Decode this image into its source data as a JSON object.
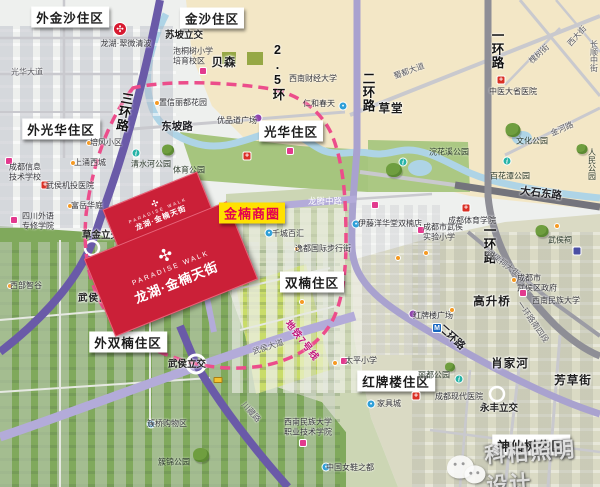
{
  "watermark": {
    "brand": "科柏照明设计",
    "icon": "wechat-icon"
  },
  "badge": {
    "text": "金楠商圈"
  },
  "paradise_walk": {
    "en": "PARADISE WALK",
    "zh": "龙湖·金楠天街"
  },
  "colors": {
    "accent_red": "#cb2038",
    "badge_yellow": "#ffe100",
    "badge_text": "#e5004f",
    "metro_pink": "#ec4d8b",
    "ring_purple": "#6a5aa8",
    "minor_purple": "#b3abd9"
  },
  "districts": [
    {
      "t": "外金沙住区",
      "x": 70,
      "y": 17
    },
    {
      "t": "金沙住区",
      "x": 212,
      "y": 18
    },
    {
      "t": "外光华住区",
      "x": 61,
      "y": 129
    },
    {
      "t": "光华住区",
      "x": 291,
      "y": 131
    },
    {
      "t": "双楠住区",
      "x": 312,
      "y": 282
    },
    {
      "t": "外双楠住区",
      "x": 128,
      "y": 342
    },
    {
      "t": "红牌楼住区",
      "x": 396,
      "y": 381
    },
    {
      "t": "神仙树住区",
      "x": 531,
      "y": 445
    }
  ],
  "zones": [
    {
      "t": "草堂",
      "x": 391,
      "y": 108
    },
    {
      "t": "贝森",
      "x": 224,
      "y": 62
    },
    {
      "t": "高升桥",
      "x": 492,
      "y": 301
    },
    {
      "t": "肖家河",
      "x": 510,
      "y": 363
    },
    {
      "t": "芳草街",
      "x": 573,
      "y": 380
    },
    {
      "t": "武侯区青年创业园",
      "x": 120,
      "y": 297,
      "sm": true
    }
  ],
  "junctions": [
    {
      "t": "苏坡立交",
      "x": 184,
      "y": 34
    },
    {
      "t": "草金立交",
      "x": 101,
      "y": 234
    },
    {
      "t": "武侯立交",
      "x": 187,
      "y": 363
    },
    {
      "t": "永丰立交",
      "x": 499,
      "y": 407
    }
  ],
  "roads": [
    {
      "t": "三环路",
      "x": 124,
      "y": 112,
      "v": true,
      "ring": true,
      "rot": 10
    },
    {
      "t": "二环路",
      "x": 368,
      "y": 92,
      "v": true,
      "ring": true
    },
    {
      "t": "一环路",
      "x": 497,
      "y": 49,
      "v": true,
      "ring": true
    },
    {
      "t": "一环路",
      "x": 489,
      "y": 244,
      "v": true,
      "ring": true
    },
    {
      "t": "2.5环",
      "x": 278,
      "y": 72,
      "v": true,
      "ring": true
    },
    {
      "t": "二环路",
      "x": 452,
      "y": 337,
      "rot": 42,
      "b": true
    },
    {
      "t": "一环路南四段",
      "x": 533,
      "y": 322,
      "rot": 55
    },
    {
      "t": "大石东路",
      "x": 541,
      "y": 193,
      "rot": 7,
      "b": true
    },
    {
      "t": "东坡路",
      "x": 177,
      "y": 126,
      "b": true
    },
    {
      "t": "光华大道",
      "x": 27,
      "y": 72
    },
    {
      "t": "蜀都大道",
      "x": 409,
      "y": 71,
      "rot": -20
    },
    {
      "t": "西大街",
      "x": 577,
      "y": 36,
      "rot": -48
    },
    {
      "t": "长顺中街",
      "x": 594,
      "y": 56,
      "v": true
    },
    {
      "t": "槐树街",
      "x": 539,
      "y": 54,
      "rot": -42
    },
    {
      "t": "金河路",
      "x": 562,
      "y": 129,
      "rot": -24
    },
    {
      "t": "武侯祠大街",
      "x": 503,
      "y": 263,
      "rot": 37
    },
    {
      "t": "武侯大道",
      "x": 268,
      "y": 347,
      "rot": -18
    },
    {
      "t": "川藏路",
      "x": 251,
      "y": 412,
      "rot": 48
    },
    {
      "t": "龙腾中路",
      "x": 325,
      "y": 201,
      "w": true
    },
    {
      "t": "晋阳路",
      "x": 192,
      "y": 223,
      "v": true,
      "w": true
    }
  ],
  "metro_label": {
    "t": "地铁7号线",
    "x": 303,
    "y": 340,
    "rot": 52
  },
  "pois": [
    {
      "t": "龙湖·翠微清波",
      "x": 126,
      "y": 44
    },
    {
      "lines": [
        "泡桐树小学",
        "培育校区"
      ],
      "x": 193,
      "y": 56,
      "icon": "school",
      "ix": 203,
      "iy": 71
    },
    {
      "t": "置信丽都花园",
      "x": 183,
      "y": 103,
      "icon": "community",
      "ix": 157,
      "iy": 103
    },
    {
      "t": "优品道广场",
      "x": 237,
      "y": 121,
      "icon": "plaza",
      "ix": 258,
      "iy": 118
    },
    {
      "t": "培风小区",
      "x": 106,
      "y": 143,
      "icon": "community",
      "ix": 89,
      "iy": 143
    },
    {
      "t": "上涌西城",
      "x": 90,
      "y": 163,
      "icon": "community",
      "ix": 73,
      "iy": 163
    },
    {
      "lines": [
        "成都信息",
        "技术学校"
      ],
      "x": 25,
      "y": 172,
      "icon": "school",
      "ix": 9,
      "iy": 161
    },
    {
      "t": "武侯机投医院",
      "x": 70,
      "y": 186,
      "icon": "hospital",
      "ix": 45,
      "iy": 185
    },
    {
      "t": "富岳华庭",
      "x": 87,
      "y": 206,
      "icon": "community",
      "ix": 70,
      "iy": 206
    },
    {
      "lines": [
        "四川外语",
        "专修学院"
      ],
      "x": 38,
      "y": 221,
      "icon": "school",
      "ix": 14,
      "iy": 220
    },
    {
      "t": "西部智谷",
      "x": 26,
      "y": 286,
      "icon": "community",
      "ix": 10,
      "iy": 286
    },
    {
      "t": "西南财经大学",
      "x": 313,
      "y": 79
    },
    {
      "t": "仁和春天",
      "x": 319,
      "y": 104,
      "icon": "shopping",
      "ix": 343,
      "iy": 106
    },
    {
      "t": "中医大省医院",
      "x": 513,
      "y": 92,
      "icon": "hospital",
      "ix": 501,
      "iy": 80
    },
    {
      "t": "成都体育学院",
      "x": 472,
      "y": 221,
      "icon": "hospital",
      "ix": 466,
      "iy": 208
    },
    {
      "t": "千城百汇",
      "x": 288,
      "y": 234,
      "icon": "shopping",
      "ix": 269,
      "iy": 233
    },
    {
      "t": "伊藤洋华堂双楠店",
      "x": 390,
      "y": 224,
      "icon": "shopping",
      "ix": 356,
      "iy": 224
    },
    {
      "t": "逸都国际步行街",
      "x": 323,
      "y": 249,
      "icon": "community",
      "ix": 297,
      "iy": 249
    },
    {
      "lines": [
        "成都市武侯",
        "实验小学"
      ],
      "x": 443,
      "y": 232,
      "icon": "school",
      "ix": 421,
      "iy": 230
    },
    {
      "lines": [
        "成都市",
        "武侯区政府"
      ],
      "x": 537,
      "y": 283,
      "icon": "community",
      "ix": 514,
      "iy": 280
    },
    {
      "t": "西南民族大学",
      "x": 556,
      "y": 301,
      "icon": "school",
      "ix": 523,
      "iy": 293
    },
    {
      "t": "太平小学",
      "x": 361,
      "y": 361,
      "icon": "school",
      "ix": 344,
      "iy": 361
    },
    {
      "t": "家具城",
      "x": 389,
      "y": 404,
      "icon": "shopping",
      "ix": 371,
      "iy": 404
    },
    {
      "t": "成都现代医院",
      "x": 459,
      "y": 397,
      "icon": "hospital",
      "ix": 416,
      "iy": 396
    },
    {
      "lines": [
        "西南民族大学",
        "职业技术学院"
      ],
      "x": 308,
      "y": 427,
      "icon": "school",
      "ix": 303,
      "iy": 443
    },
    {
      "t": "中国女鞋之都",
      "x": 350,
      "y": 468,
      "icon": "shopping",
      "ix": 326,
      "iy": 467
    },
    {
      "t": "簇桥购物区",
      "x": 167,
      "y": 424,
      "icon": "shopping",
      "ix": 151,
      "iy": 424
    },
    {
      "t": "红牌楼广场",
      "x": 433,
      "y": 316,
      "icon": "plaza",
      "ix": 413,
      "iy": 314
    }
  ],
  "parks": [
    {
      "t": "清水河公园",
      "x": 151,
      "y": 164,
      "info": [
        136,
        153
      ],
      "tree": [
        168,
        150,
        12
      ]
    },
    {
      "t": "体育公园",
      "x": 189,
      "y": 170
    },
    {
      "t": "文化公园",
      "x": 532,
      "y": 141,
      "tree": [
        513,
        130,
        15
      ]
    },
    {
      "t": "百花潭公园",
      "x": 510,
      "y": 176,
      "info": [
        507,
        161
      ]
    },
    {
      "t": "浣花溪公园",
      "x": 449,
      "y": 152,
      "info": [
        403,
        162
      ],
      "tree": [
        394,
        170,
        16
      ]
    },
    {
      "t": "人民公园",
      "x": 592,
      "y": 164,
      "v": true,
      "tree": [
        582,
        149,
        11
      ]
    },
    {
      "t": "武侯祠",
      "x": 560,
      "y": 240,
      "tree": [
        542,
        231,
        13
      ]
    },
    {
      "t": "丽都公园",
      "x": 434,
      "y": 375,
      "tree": [
        450,
        367,
        10
      ],
      "info": [
        459,
        379
      ]
    },
    {
      "t": "簇锦公园",
      "x": 174,
      "y": 462,
      "tree": [
        201,
        455,
        16
      ]
    }
  ],
  "icons": [
    {
      "type": "longfor",
      "x": 120,
      "y": 29
    },
    {
      "type": "metro",
      "x": 150,
      "y": 310
    },
    {
      "type": "metro",
      "x": 437,
      "y": 328
    },
    {
      "type": "museum",
      "x": 577,
      "y": 251
    },
    {
      "type": "bus",
      "x": 140,
      "y": 249
    },
    {
      "type": "bus",
      "x": 218,
      "y": 380
    },
    {
      "type": "hospital",
      "x": 247,
      "y": 156
    },
    {
      "type": "school",
      "x": 290,
      "y": 151
    },
    {
      "type": "school",
      "x": 375,
      "y": 205
    },
    {
      "type": "community",
      "x": 398,
      "y": 258
    },
    {
      "type": "community",
      "x": 426,
      "y": 253
    },
    {
      "type": "community",
      "x": 452,
      "y": 310
    },
    {
      "type": "community",
      "x": 302,
      "y": 302
    },
    {
      "type": "community",
      "x": 335,
      "y": 363
    },
    {
      "type": "community",
      "x": 557,
      "y": 226
    }
  ]
}
